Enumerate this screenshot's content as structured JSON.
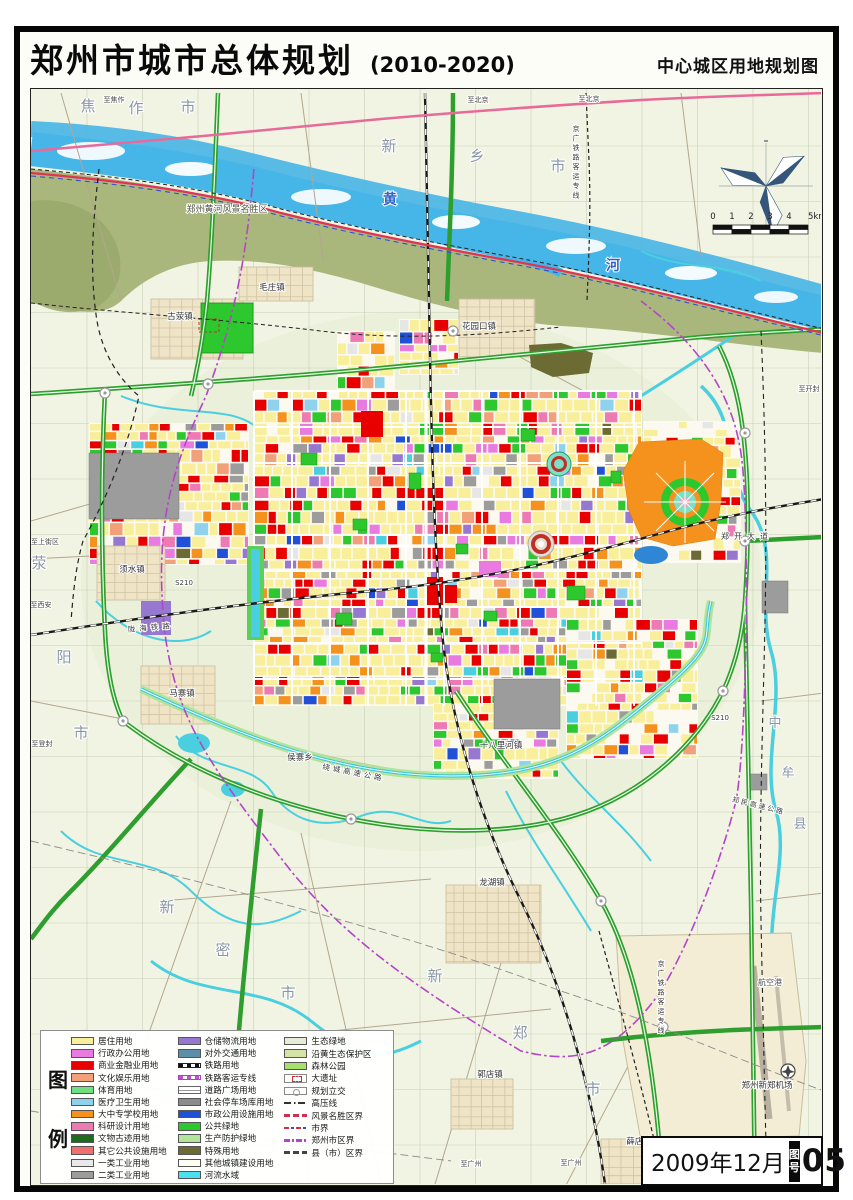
{
  "title": {
    "main": "郑州市城市总体规划",
    "period": "(2010-2020)",
    "subtitle": "中心城区用地规划图"
  },
  "sheet": {
    "date": "2009年12月",
    "label": "图号",
    "number": "05"
  },
  "scalebar": {
    "labels": [
      "0",
      "1",
      "2",
      "3",
      "4",
      "5km"
    ]
  },
  "legend": {
    "heading": "图例",
    "columns": [
      {
        "items": [
          {
            "label": "居住用地",
            "swatch": "fill",
            "color": "#f9ef9a"
          },
          {
            "label": "行政办公用地",
            "swatch": "fill",
            "color": "#e87ae0"
          },
          {
            "label": "商业金融业用地",
            "swatch": "fill",
            "color": "#e80000"
          },
          {
            "label": "文化娱乐用地",
            "swatch": "fill",
            "color": "#f2a07a"
          },
          {
            "label": "体育用地",
            "swatch": "fill",
            "color": "#6fe07f"
          },
          {
            "label": "医疗卫生用地",
            "swatch": "fill",
            "color": "#8ed2ee"
          },
          {
            "label": "大中专学校用地",
            "swatch": "fill",
            "color": "#f5921e"
          },
          {
            "label": "科研设计用地",
            "swatch": "fill",
            "color": "#ee7ab4"
          },
          {
            "label": "文物古迹用地",
            "swatch": "fill",
            "color": "#1e6b1e"
          },
          {
            "label": "其它公共设施用地",
            "swatch": "fill",
            "color": "#f07070"
          },
          {
            "label": "一类工业用地",
            "swatch": "fill",
            "color": "#e9e9e9"
          },
          {
            "label": "二类工业用地",
            "swatch": "fill",
            "color": "#9c9c9c"
          }
        ]
      },
      {
        "items": [
          {
            "label": "仓储物流用地",
            "swatch": "fill",
            "color": "#9678d0"
          },
          {
            "label": "对外交通用地",
            "swatch": "fill",
            "color": "#5b8fa8"
          },
          {
            "label": "铁路用地",
            "swatch": "rail",
            "color": "#111111"
          },
          {
            "label": "铁路客运专线",
            "swatch": "railm",
            "color": "#c050d0"
          },
          {
            "label": "道路广场用地",
            "swatch": "road",
            "color": "#ffffff"
          },
          {
            "label": "社会停车场库用地",
            "swatch": "fill",
            "color": "#8c8c8c"
          },
          {
            "label": "市政公用设施用地",
            "swatch": "fill",
            "color": "#2050d8"
          },
          {
            "label": "公共绿地",
            "swatch": "fill",
            "color": "#2dc82d"
          },
          {
            "label": "生产防护绿地",
            "swatch": "fill",
            "color": "#b2e49a"
          },
          {
            "label": "特殊用地",
            "swatch": "fill",
            "color": "#6b6b33"
          },
          {
            "label": "其他城镇建设用地",
            "swatch": "fill",
            "color": "#fdfdf2"
          },
          {
            "label": "河流水域",
            "swatch": "fill",
            "color": "#49e0f0"
          }
        ]
      },
      {
        "items": [
          {
            "label": "生态绿地",
            "swatch": "fill",
            "color": "#e6ecd8"
          },
          {
            "label": "沿黄生态保护区",
            "swatch": "fill",
            "color": "#d6e3a8"
          },
          {
            "label": "森林公园",
            "swatch": "fill",
            "color": "#a8e070"
          },
          {
            "label": "大遗址",
            "swatch": "site",
            "color": "#c03030"
          },
          {
            "label": "规划立交",
            "swatch": "ic",
            "color": "#999999"
          },
          {
            "label": "高压线",
            "swatch": "hv",
            "color": "#333333"
          },
          {
            "label": "风景名胜区界",
            "swatch": "line",
            "color": "#d03050"
          },
          {
            "label": "市界",
            "swatch": "redblue",
            "color": "#d03050"
          },
          {
            "label": "郑州市区界",
            "swatch": "dashdot",
            "color": "#b345c8"
          },
          {
            "label": "县（市）区界",
            "swatch": "line",
            "color": "#444444"
          }
        ]
      }
    ]
  },
  "map_palette": {
    "residential": "#f9ef9a",
    "commercial": "#e80000",
    "admin": "#e87ae0",
    "culture": "#f2a07a",
    "school": "#f5921e",
    "research": "#ee7ab4",
    "public_green": "#2dc82d",
    "industry1": "#e6e6e6",
    "industry2": "#9c9c9c",
    "municipal": "#2050d8",
    "logistics": "#9678d0",
    "special": "#6b6b33",
    "medical": "#8ed2ee",
    "water": "#49cfe0",
    "protect_green": "#b2e49a",
    "eco_green": "#e9efdb",
    "floodplain": "#a9b77c",
    "forest": "#a8e070",
    "village_tan": "#efe5c6",
    "river_blue": "#46b5e7",
    "boundary_city": "#b345c8",
    "scenic_line": "#e03356",
    "rail_black": "#1a1a1a",
    "expressway_green": "#2e9e2e"
  },
  "map_labels": [
    {
      "t": "焦作市",
      "spread": [
        [
          87,
          110
        ],
        [
          135,
          112
        ],
        [
          187,
          111
        ]
      ],
      "s": 15,
      "c": "#8a96a6"
    },
    {
      "t": "新乡市",
      "spread": [
        [
          388,
          150
        ],
        [
          476,
          160
        ],
        [
          557,
          170
        ]
      ],
      "s": 15,
      "c": "#8a96a6"
    },
    {
      "t": "黄河",
      "spread": [
        [
          389,
          203
        ],
        [
          612,
          269
        ]
      ],
      "s": 14,
      "c": "#2f63c4",
      "b": 1
    },
    {
      "t": "荥阳市",
      "spread": [
        [
          38,
          567
        ],
        [
          63,
          661
        ],
        [
          80,
          737
        ]
      ],
      "s": 15,
      "c": "#8a96a6"
    },
    {
      "t": "新密市",
      "spread": [
        [
          166,
          911
        ],
        [
          222,
          954
        ],
        [
          287,
          997
        ]
      ],
      "s": 15,
      "c": "#8a96a6"
    },
    {
      "t": "新郑市",
      "spread": [
        [
          434,
          980
        ],
        [
          519,
          1037
        ],
        [
          592,
          1093
        ]
      ],
      "s": 15,
      "c": "#8a96a6"
    },
    {
      "t": "中牟县",
      "spread": [
        [
          774,
          726
        ],
        [
          787,
          776
        ],
        [
          799,
          827
        ]
      ],
      "s": 13,
      "c": "#8a96a6"
    },
    {
      "t": "郑州黄河风景名胜区",
      "x": 226,
      "y": 211,
      "s": 9,
      "c": "#4f5340"
    },
    {
      "t": "古荥镇",
      "x": 179,
      "y": 318,
      "s": 8.5,
      "c": "#333333"
    },
    {
      "t": "毛庄镇",
      "x": 271,
      "y": 289,
      "s": 8.5,
      "c": "#333333"
    },
    {
      "t": "花园口镇",
      "x": 478,
      "y": 328,
      "s": 8.5,
      "c": "#333333"
    },
    {
      "t": "须水镇",
      "x": 131,
      "y": 571,
      "s": 8.5,
      "c": "#333333"
    },
    {
      "t": "马寨镇",
      "x": 181,
      "y": 695,
      "s": 8.5,
      "c": "#333333"
    },
    {
      "t": "侯寨乡",
      "x": 299,
      "y": 759,
      "s": 8.5,
      "c": "#333333"
    },
    {
      "t": "十八里河镇",
      "x": 500,
      "y": 747,
      "s": 8.5,
      "c": "#333333"
    },
    {
      "t": "龙湖镇",
      "x": 491,
      "y": 884,
      "s": 8.5,
      "c": "#333333"
    },
    {
      "t": "薛店镇",
      "x": 638,
      "y": 1143,
      "s": 8.5,
      "c": "#333333"
    },
    {
      "t": "郭店镇",
      "x": 489,
      "y": 1076,
      "s": 8.5,
      "c": "#333333"
    },
    {
      "t": "郑州新郑机场",
      "x": 766,
      "y": 1087,
      "s": 8.5,
      "c": "#333333"
    },
    {
      "t": "航空港",
      "x": 769,
      "y": 984,
      "s": 8,
      "c": "#555555"
    },
    {
      "t": "郑开大道",
      "x": 746,
      "y": 538,
      "s": 8,
      "c": "#3a3a3a",
      "ls": 5
    },
    {
      "t": "S210",
      "x": 183,
      "y": 584,
      "s": 7,
      "c": "#3a3a3a"
    },
    {
      "t": "S210",
      "x": 719,
      "y": 719,
      "s": 7,
      "c": "#3a3a3a"
    },
    {
      "t": "陇海铁路",
      "x": 150,
      "y": 629,
      "s": 7.5,
      "c": "#3a3a3a",
      "rot": -5,
      "ls": 4
    },
    {
      "t": "京广铁路客运专线",
      "x": 575,
      "y": 130,
      "s": 7,
      "c": "#3a3a3a",
      "vert": 1
    },
    {
      "t": "京广铁路客运专线",
      "x": 660,
      "y": 965,
      "s": 7,
      "c": "#3a3a3a",
      "vert": 1
    },
    {
      "t": "绕城高速公路",
      "x": 352,
      "y": 774,
      "s": 7.5,
      "c": "#3a3a3a",
      "rot": 11,
      "ls": 3
    },
    {
      "t": "郑民高速公路",
      "x": 757,
      "y": 807,
      "s": 7,
      "c": "#3a3a3a",
      "rot": 14,
      "ls": 2
    },
    {
      "t": "至北京",
      "x": 477,
      "y": 101,
      "s": 7,
      "c": "#444444"
    },
    {
      "t": "至北京",
      "x": 588,
      "y": 100,
      "s": 7,
      "c": "#444444"
    },
    {
      "t": "至焦作",
      "x": 113,
      "y": 101,
      "s": 7,
      "c": "#444444"
    },
    {
      "t": "至上街区",
      "x": 44,
      "y": 543,
      "s": 7,
      "c": "#444444"
    },
    {
      "t": "至西安",
      "x": 40,
      "y": 606,
      "s": 7,
      "c": "#444444"
    },
    {
      "t": "至登封",
      "x": 41,
      "y": 745,
      "s": 7,
      "c": "#444444"
    },
    {
      "t": "至开封",
      "x": 808,
      "y": 390,
      "s": 7,
      "c": "#444444"
    },
    {
      "t": "至广州",
      "x": 470,
      "y": 1165,
      "s": 7,
      "c": "#444444"
    },
    {
      "t": "至广州",
      "x": 570,
      "y": 1164,
      "s": 7,
      "c": "#444444"
    }
  ]
}
